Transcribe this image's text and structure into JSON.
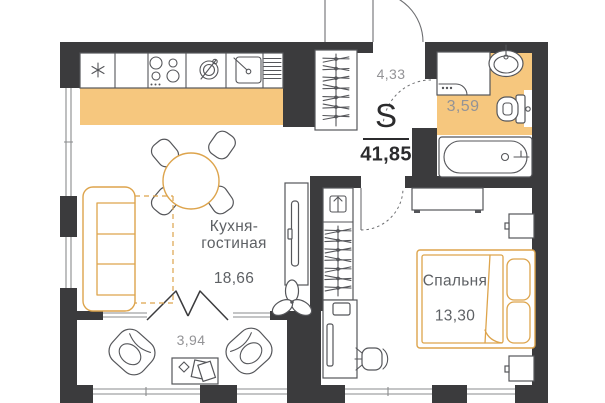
{
  "floor_plan": {
    "summary": {
      "area_symbol": "S",
      "total_area": "41,85"
    },
    "rooms": {
      "kitchen_living": {
        "name": "Кухня-\nгостиная",
        "area": "18,66"
      },
      "bedroom": {
        "name": "Спальня",
        "area": "13,30"
      },
      "hallway": {
        "area": "4,33"
      },
      "bathroom": {
        "area": "3,59"
      },
      "balcony": {
        "area": "3,94"
      }
    },
    "colors": {
      "wall": "#3b3b3d",
      "highlight_fill": "#f6c77e",
      "furniture_accent": "#dda44c",
      "furniture_line": "#55565a",
      "window_line": "#8a8b8d",
      "door_line": "#6e6f72",
      "label_dark": "#5e6165",
      "label_light": "#939396",
      "total_dark": "#2b2b2d"
    }
  }
}
